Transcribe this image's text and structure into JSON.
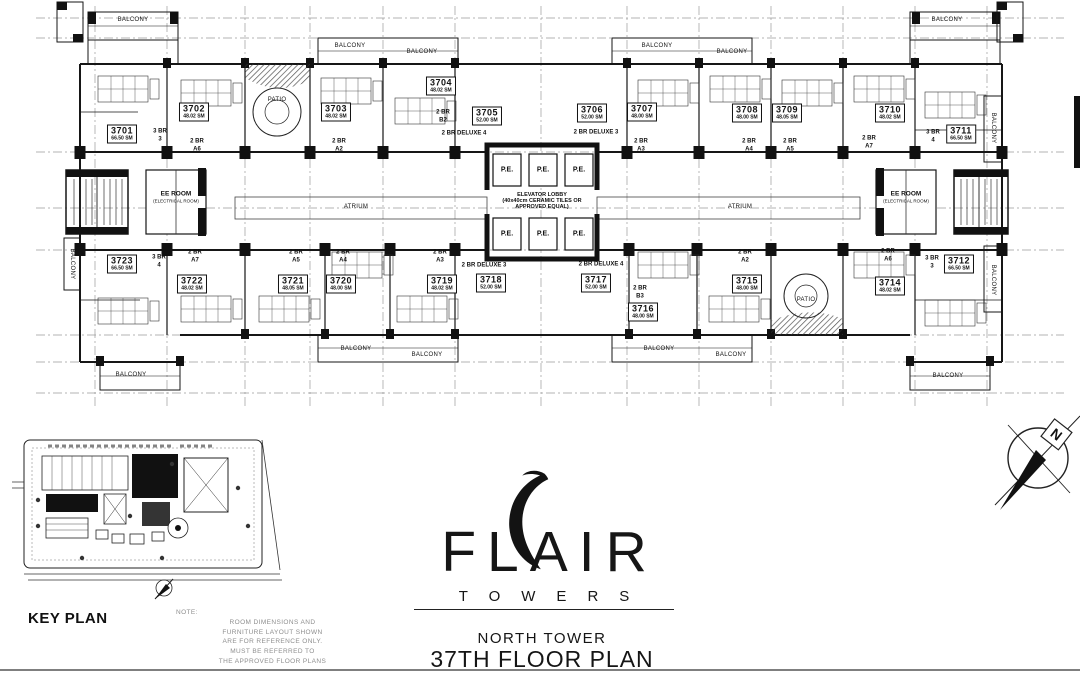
{
  "document": {
    "brand": "FLAIR",
    "brand_sub": "TOWERS",
    "tower": "NORTH TOWER",
    "plan_title": "37TH FLOOR PLAN",
    "key_plan_label": "KEY PLAN"
  },
  "compass": {
    "north": "N"
  },
  "plan": {
    "core": {
      "elevator_lobby": [
        "ELEVATOR LOBBY",
        "(40x40cm CERAMIC TILES OR",
        "APPROVED EQUAL)"
      ],
      "pe_label": "P.E."
    },
    "service": {
      "rooms": [
        {
          "label": "EE ROOM",
          "sub": "(ELECTRICAL ROOM)",
          "x": 176,
          "y": 197
        },
        {
          "label": "EE ROOM",
          "sub": "(ELECTRICAL ROOM)",
          "x": 906,
          "y": 197
        }
      ]
    },
    "units": [
      {
        "no": "3701",
        "area": "66.50 SM",
        "type": [
          "3 BR",
          "3"
        ],
        "x": 122,
        "y": 134,
        "tx": 160,
        "ty": 136
      },
      {
        "no": "3702",
        "area": "48.02 SM",
        "type": [
          "2 BR",
          "A6"
        ],
        "x": 194,
        "y": 112,
        "tx": 197,
        "ty": 146
      },
      {
        "no": "3703",
        "area": "48.02 SM",
        "type": [
          "2 BR",
          "A2"
        ],
        "x": 336,
        "y": 112,
        "tx": 339,
        "ty": 146
      },
      {
        "no": "3704",
        "area": "48.02 SM",
        "type": [
          "2 BR",
          "B2"
        ],
        "x": 441,
        "y": 86,
        "tx": 443,
        "ty": 117
      },
      {
        "no": "3705",
        "area": "52.00 SM",
        "type": [
          "2 BR DELUXE 4"
        ],
        "x": 487,
        "y": 116,
        "tx": 464,
        "ty": 134
      },
      {
        "no": "3706",
        "area": "52.00 SM",
        "type": [
          "2 BR DELUXE 3"
        ],
        "x": 592,
        "y": 113,
        "tx": 596,
        "ty": 133
      },
      {
        "no": "3707",
        "area": "48.00 SM",
        "type": [
          "2 BR",
          "A3"
        ],
        "x": 642,
        "y": 112,
        "tx": 641,
        "ty": 146
      },
      {
        "no": "3708",
        "area": "48.00 SM",
        "type": [
          "2 BR",
          "A4"
        ],
        "x": 747,
        "y": 113,
        "tx": 749,
        "ty": 146
      },
      {
        "no": "3709",
        "area": "48.05 SM",
        "type": [
          "2 BR",
          "A5"
        ],
        "x": 787,
        "y": 113,
        "tx": 790,
        "ty": 146
      },
      {
        "no": "3710",
        "area": "48.02 SM",
        "type": [
          "2 BR",
          "A7"
        ],
        "x": 890,
        "y": 113,
        "tx": 869,
        "ty": 143
      },
      {
        "no": "3711",
        "area": "66.50 SM",
        "type": [
          "3 BR",
          "4"
        ],
        "x": 961,
        "y": 134,
        "tx": 933,
        "ty": 137
      },
      {
        "no": "3723",
        "area": "66.50 SM",
        "type": [
          "3 BR",
          "4"
        ],
        "x": 122,
        "y": 264,
        "tx": 159,
        "ty": 262
      },
      {
        "no": "3722",
        "area": "48.02 SM",
        "type": [
          "2 BR",
          "A7"
        ],
        "x": 192,
        "y": 284,
        "tx": 195,
        "ty": 257
      },
      {
        "no": "3721",
        "area": "48.05 SM",
        "type": [
          "2 BR",
          "A5"
        ],
        "x": 293,
        "y": 284,
        "tx": 296,
        "ty": 257
      },
      {
        "no": "3720",
        "area": "48.00 SM",
        "type": [
          "2 BR",
          "A4"
        ],
        "x": 341,
        "y": 284,
        "tx": 343,
        "ty": 257
      },
      {
        "no": "3719",
        "area": "48.02 SM",
        "type": [
          "2 BR",
          "A3"
        ],
        "x": 442,
        "y": 284,
        "tx": 440,
        "ty": 257
      },
      {
        "no": "3718",
        "area": "52.00 SM",
        "type": [
          "2 BR DELUXE 3"
        ],
        "x": 491,
        "y": 283,
        "tx": 484,
        "ty": 266
      },
      {
        "no": "3717",
        "area": "52.00 SM",
        "type": [
          "2 BR DELUXE 4"
        ],
        "x": 596,
        "y": 283,
        "tx": 601,
        "ty": 265
      },
      {
        "no": "3716",
        "area": "48.00 SM",
        "type": [
          "2 BR",
          "B3"
        ],
        "x": 643,
        "y": 312,
        "tx": 640,
        "ty": 293
      },
      {
        "no": "3715",
        "area": "48.00 SM",
        "type": [
          "2 BR",
          "A2"
        ],
        "x": 747,
        "y": 284,
        "tx": 745,
        "ty": 257
      },
      {
        "no": "3714",
        "area": "48.02 SM",
        "type": [
          "2 BR",
          "A6"
        ],
        "x": 890,
        "y": 286,
        "tx": 888,
        "ty": 256
      },
      {
        "no": "3712",
        "area": "66.50 SM",
        "type": [
          "3 BR",
          "3"
        ],
        "x": 959,
        "y": 264,
        "tx": 932,
        "ty": 263
      }
    ],
    "labels": [
      {
        "t": "BALCONY",
        "x": 133,
        "y": 20
      },
      {
        "t": "BALCONY",
        "x": 350,
        "y": 46
      },
      {
        "t": "BALCONY",
        "x": 422,
        "y": 52
      },
      {
        "t": "BALCONY",
        "x": 657,
        "y": 46
      },
      {
        "t": "BALCONY",
        "x": 732,
        "y": 52
      },
      {
        "t": "BALCONY",
        "x": 947,
        "y": 20
      },
      {
        "t": "BALCONY",
        "x": 993,
        "y": 128,
        "v": true
      },
      {
        "t": "BALCONY",
        "x": 993,
        "y": 280,
        "v": true
      },
      {
        "t": "BALCONY",
        "x": 72,
        "y": 264,
        "v": true
      },
      {
        "t": "BALCONY",
        "x": 131,
        "y": 375
      },
      {
        "t": "BALCONY",
        "x": 356,
        "y": 349
      },
      {
        "t": "BALCONY",
        "x": 427,
        "y": 355
      },
      {
        "t": "BALCONY",
        "x": 659,
        "y": 349
      },
      {
        "t": "BALCONY",
        "x": 731,
        "y": 355
      },
      {
        "t": "BALCONY",
        "x": 948,
        "y": 376
      },
      {
        "t": "PATIO",
        "x": 277,
        "y": 100
      },
      {
        "t": "PATIO",
        "x": 806,
        "y": 300
      },
      {
        "t": "ATRIUM",
        "x": 356,
        "y": 207
      },
      {
        "t": "ATRIUM",
        "x": 740,
        "y": 207
      }
    ]
  },
  "note": {
    "lines": [
      "NOTE:",
      "ROOM DIMENSIONS AND",
      "FURNITURE LAYOUT SHOWN",
      "ARE FOR REFERENCE ONLY.",
      "MUST BE REFERRED TO",
      "THE APPROVED FLOOR PLANS"
    ]
  }
}
